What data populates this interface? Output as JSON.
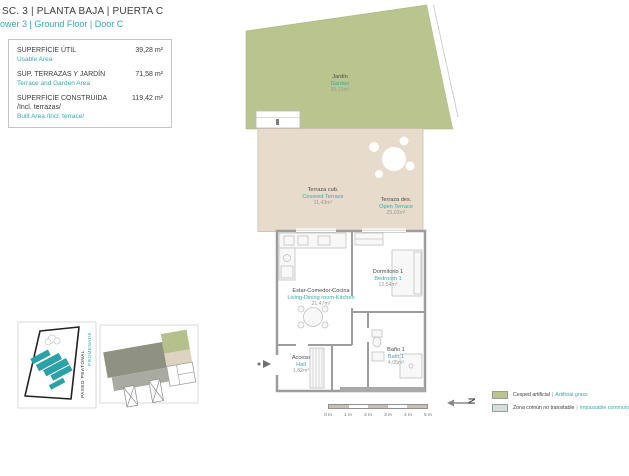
{
  "header": {
    "title": "SC. 3 | PLANTA BAJA | PUERTA C",
    "subtitle": "ower 3 | Ground Floor | Door C"
  },
  "summary": {
    "rows": [
      {
        "label_es": "SUPERFICIE ÚTIL",
        "label_en": "Usable Area",
        "value": "39,28 m²"
      },
      {
        "label_es": "SUP. TERRAZAS Y JARDÍN",
        "label_en": "Terrace and Garden Area",
        "value": "71,58 m²"
      },
      {
        "label_es": "SUPERFICIE CONSTRUIDA",
        "label_es2": "/Incl. terrazas/",
        "label_en": "Built Area /Incl. terrace/",
        "value": "119,42 m²"
      }
    ]
  },
  "plan": {
    "rooms": [
      {
        "name_es": "Jardín",
        "name_en": "Garden",
        "area": "35,13m²"
      },
      {
        "name_es": "Terraza cub.",
        "name_en": "Covered Terrace",
        "area": "11,43m²"
      },
      {
        "name_es": "Terraza des.",
        "name_en": "Open Terrace",
        "area": "25,02m²"
      },
      {
        "name_es": "Estar-Comedor-Cocina",
        "name_en": "Living-Dining room-Kitchen",
        "area": "21,47m²"
      },
      {
        "name_es": "Dormitorio 1",
        "name_en": "Bedroom 1",
        "area": "12,54m²"
      },
      {
        "name_es": "Baño 1",
        "name_en": "Bath 1",
        "area": "4,05m²"
      },
      {
        "name_es": "Acceso",
        "name_en": "Hall",
        "area": "1,82m²"
      }
    ]
  },
  "sitemap": {
    "street_label_es": "PASEO PEATONAL",
    "street_label_en": "PROMENADE"
  },
  "north": {
    "label": "N"
  },
  "scalebar": {
    "ticks": [
      "0 m",
      "1 m",
      "2 m",
      "3 m",
      "4 m",
      "5 m"
    ]
  },
  "legend": {
    "items": [
      {
        "label_es": "Cesped artificial",
        "label_en": "Artificial grass",
        "color": "#b9c48e"
      },
      {
        "label_es": "Zona común no transitable",
        "label_en": "Impassable communal area",
        "color": "#d6dedc"
      }
    ]
  },
  "colors": {
    "accent_teal": "#35aab0",
    "garden_green": "#b9c48e",
    "terrace_beige": "#e7dccb",
    "wall_gray": "#9d9d9d"
  }
}
